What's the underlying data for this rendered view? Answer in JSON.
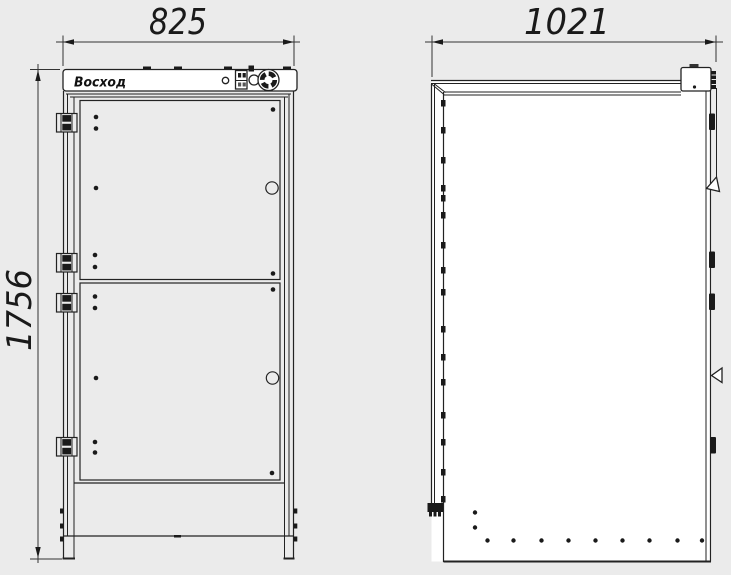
{
  "colors": {
    "background": "#ebebeb",
    "line": "#222222",
    "panel_fill": "#ffffff"
  },
  "front_view": {
    "width_dimension": "825",
    "height_dimension": "1756",
    "logo_text": "Восход"
  },
  "side_view": {
    "depth_dimension": "1021"
  }
}
